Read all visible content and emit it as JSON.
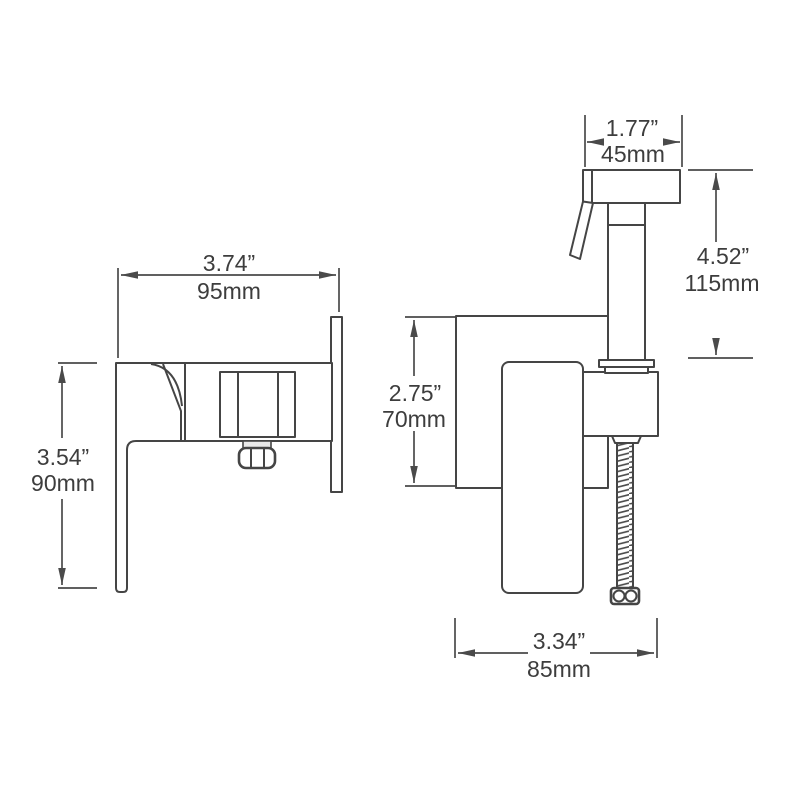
{
  "page": {
    "background": "#ffffff",
    "line_color": "#454545",
    "text_color": "#3d3d3d"
  },
  "drawing": {
    "side_view": {
      "width": {
        "in": "3.74”",
        "mm": "95mm"
      },
      "height": {
        "in": "3.54”",
        "mm": "90mm"
      }
    },
    "front_view": {
      "head_width": {
        "in": "1.77”",
        "mm": "45mm"
      },
      "sprayer_height": {
        "in": "4.52”",
        "mm": "115mm"
      },
      "body_height": {
        "in": "2.75”",
        "mm": "70mm"
      },
      "body_width": {
        "in": "3.34”",
        "mm": "85mm"
      }
    }
  }
}
